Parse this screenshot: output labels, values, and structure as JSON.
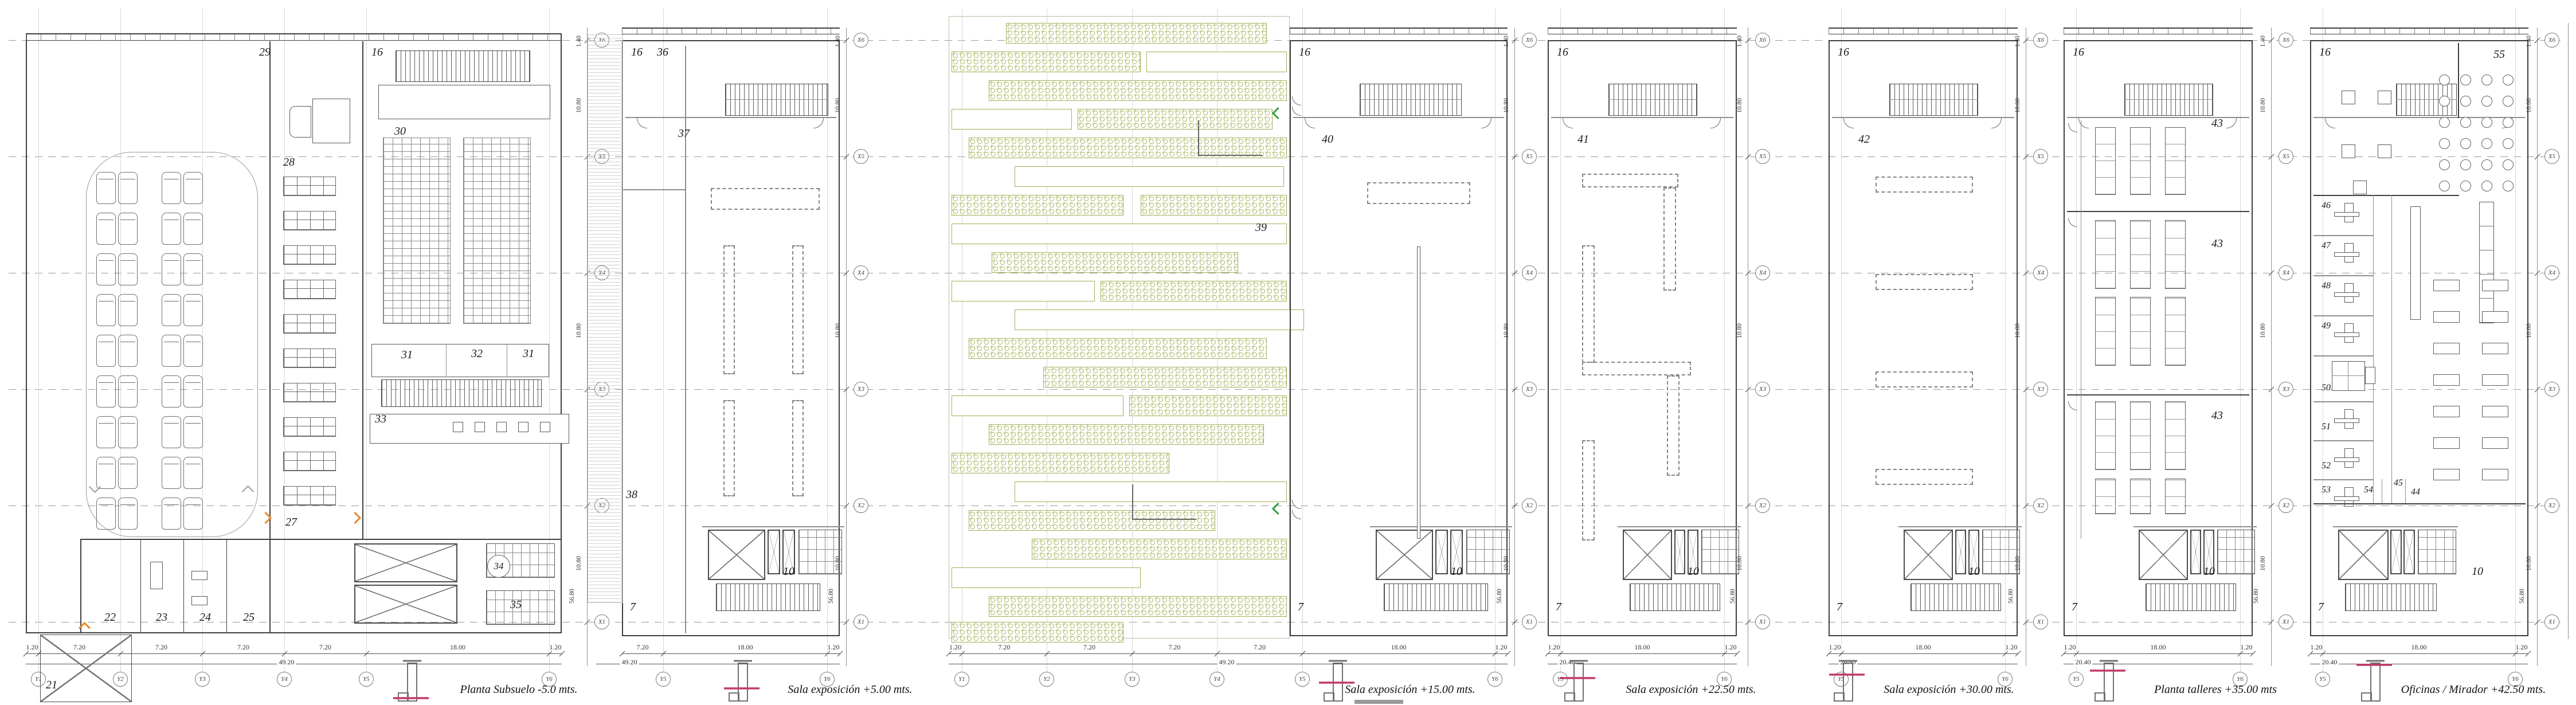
{
  "sheet": {
    "background": "#ffffff",
    "line_color": "#3f3f3f",
    "accent_orange": "#e6892b",
    "accent_green": "#2f9e3f",
    "accent_red": "#c43a64",
    "hatch_olive": "#a3ae58",
    "grid_label_rows": [
      "X6",
      "X5",
      "X4",
      "X3",
      "X2",
      "X1"
    ],
    "vdim_labels": [
      "1.40",
      "10.80",
      "10.80",
      "10.80",
      "56.80"
    ]
  },
  "drawings": [
    {
      "id": "subsuelo",
      "title": "Planta Subsuelo -5.0 mts.",
      "dim_segments": [
        "1.20",
        "7.20",
        "7.20",
        "7.20",
        "7.20",
        "18.00",
        "1.20"
      ],
      "dim_total": "49.20",
      "col_grid": [
        "Y1",
        "Y2",
        "Y3",
        "Y4",
        "Y5",
        "Y6"
      ],
      "rooms": {
        "r21": "21",
        "r22": "22",
        "r23": "23",
        "r24": "24",
        "r25": "25",
        "r27": "27",
        "r28": "28",
        "r29": "29",
        "r16": "16",
        "r30": "30",
        "r31a": "31",
        "r32": "32",
        "r31b": "31",
        "r33": "33",
        "r34": "34",
        "r35": "35"
      }
    },
    {
      "id": "expo5",
      "title": "Sala exposición +5.00 mts.",
      "dim_segments": [
        "7.20",
        "18.00",
        "1.20"
      ],
      "dim_total": "49.20",
      "col_grid": [
        "Y5",
        "Y6"
      ],
      "rooms": {
        "r36": "36",
        "r16": "16",
        "r37": "37",
        "r38": "38",
        "r7": "7",
        "r10": "10"
      }
    },
    {
      "id": "expo15",
      "title": "Sala exposición +15.00 mts.",
      "dim_segments": [
        "1.20",
        "7.20",
        "7.20",
        "7.20",
        "7.20",
        "18.00",
        "1.20"
      ],
      "dim_total": "49.20",
      "col_grid": [
        "Y1",
        "Y2",
        "Y3",
        "Y4",
        "Y5",
        "Y6"
      ],
      "rooms": {
        "r39": "39",
        "r16": "16",
        "r40": "40",
        "r7": "7",
        "r10": "10"
      }
    },
    {
      "id": "expo225",
      "title": "Sala exposición +22.50 mts.",
      "dim_segments": [
        "1.20",
        "18.00",
        "1.20"
      ],
      "dim_total": "20.40",
      "col_grid": [
        "Y5",
        "Y6"
      ],
      "rooms": {
        "r16": "16",
        "r41": "41",
        "r7": "7",
        "r10": "10"
      }
    },
    {
      "id": "expo30",
      "title": "Sala exposición +30.00 mts.",
      "dim_segments": [
        "1.20",
        "18.00",
        "1.20"
      ],
      "dim_total": "20.40",
      "col_grid": [
        "Y5",
        "Y6"
      ],
      "rooms": {
        "r16": "16",
        "r42": "42",
        "r7": "7",
        "r10": "10"
      }
    },
    {
      "id": "talleres",
      "title": "Planta talleres  +35.00 mts",
      "dim_segments": [
        "1.20",
        "18.00",
        "1.20"
      ],
      "dim_total": "20.40",
      "col_grid": [
        "Y5",
        "Y6"
      ],
      "rooms": {
        "r16": "16",
        "r43a": "43",
        "r43b": "43",
        "r43c": "43",
        "r7": "7",
        "r10": "10"
      }
    },
    {
      "id": "oficinas",
      "title": "Oficinas / Mirador +42.50 mts.",
      "dim_segments": [
        "1.20",
        "18.00",
        "1.20"
      ],
      "dim_total": "20.40",
      "col_grid": [
        "Y5",
        "Y6"
      ],
      "rooms": {
        "r16": "16",
        "r55": "55",
        "r46": "46",
        "r47": "47",
        "r48": "48",
        "r49": "49",
        "r50": "50",
        "r51": "51",
        "r52": "52",
        "r53": "53",
        "r54": "54",
        "r45": "45",
        "r44": "44",
        "r10": "10",
        "r7": "7"
      }
    }
  ]
}
